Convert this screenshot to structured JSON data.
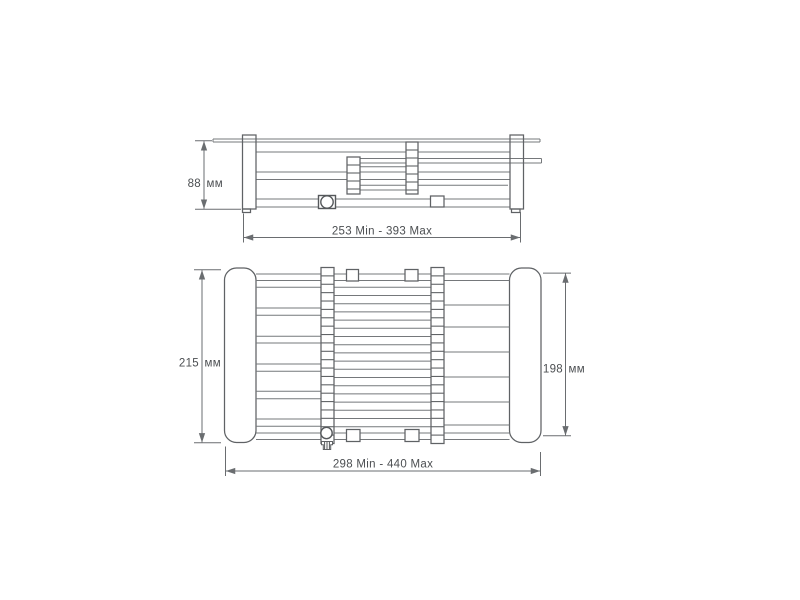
{
  "colors": {
    "background": "#ffffff",
    "line": "#6a6d70",
    "text": "#4c4f52"
  },
  "dimensions": {
    "side_view": {
      "height_value": "88",
      "height_unit": "мм",
      "width_range": "253 Min - 393 Max"
    },
    "plan_view": {
      "left_height_value": "215",
      "left_height_unit": "мм",
      "right_height_value": "198",
      "right_height_unit": "мм",
      "width_range": "298 Min - 440 Max"
    }
  }
}
